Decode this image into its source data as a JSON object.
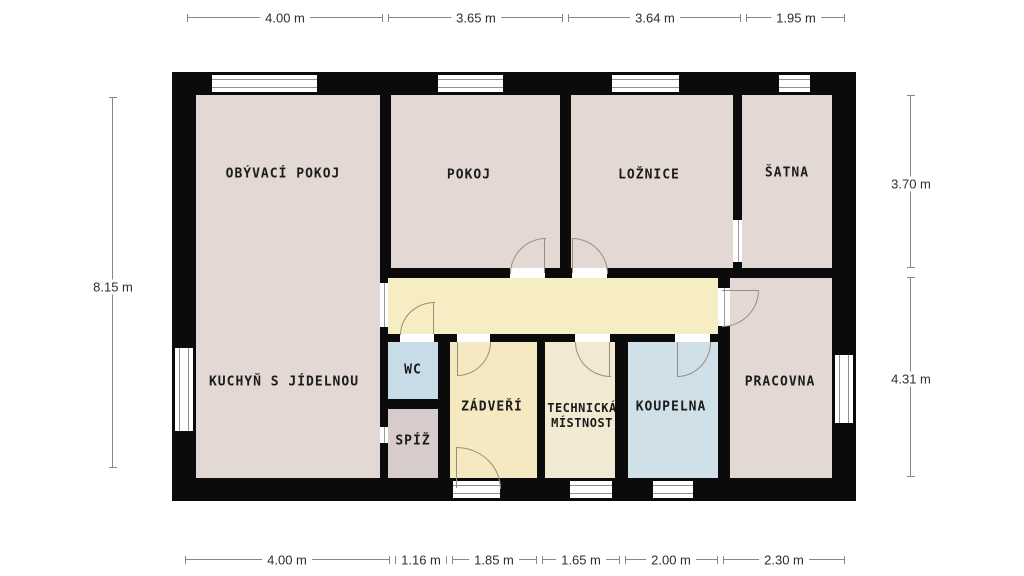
{
  "plan": {
    "type": "floor-plan",
    "rooms": {
      "living": "OBÝVACÍ POKOJ",
      "kitchen": "KUCHYŇ S JÍDELNOU",
      "room": "POKOJ",
      "bedroom": "LOŽNICE",
      "wardrobe": "ŠATNA",
      "wc": "WC",
      "pantry": "SPÍŽ",
      "entry": "ZÁDVEŘÍ",
      "technical_line1": "TECHNICKÁ",
      "technical_line2": "MÍSTNOST",
      "bathroom": "KOUPELNA",
      "study": "PRACOVNA"
    },
    "dimensions": {
      "top": [
        "4.00 m",
        "3.65 m",
        "3.64 m",
        "1.95 m"
      ],
      "bottom": [
        "4.00 m",
        "1.16 m",
        "1.85 m",
        "1.65 m",
        "2.00 m",
        "2.30 m"
      ],
      "left": [
        "8.15 m"
      ],
      "right": [
        "3.70 m",
        "4.31 m"
      ]
    },
    "colors": {
      "wall": "#0b0b0b",
      "room_pink": "#e3d8d3",
      "corridor_yellow": "#f7edc3",
      "entry_yellow": "#f5e9c1",
      "technical_cream": "#f2e9d3",
      "wc_blue": "#c8dce7",
      "bathroom_blue": "#cfe0e9",
      "pantry_mauve": "#d8cbcc",
      "dimension_line": "#878787",
      "door_line": "#9a8d7c",
      "background": "#ffffff"
    }
  }
}
